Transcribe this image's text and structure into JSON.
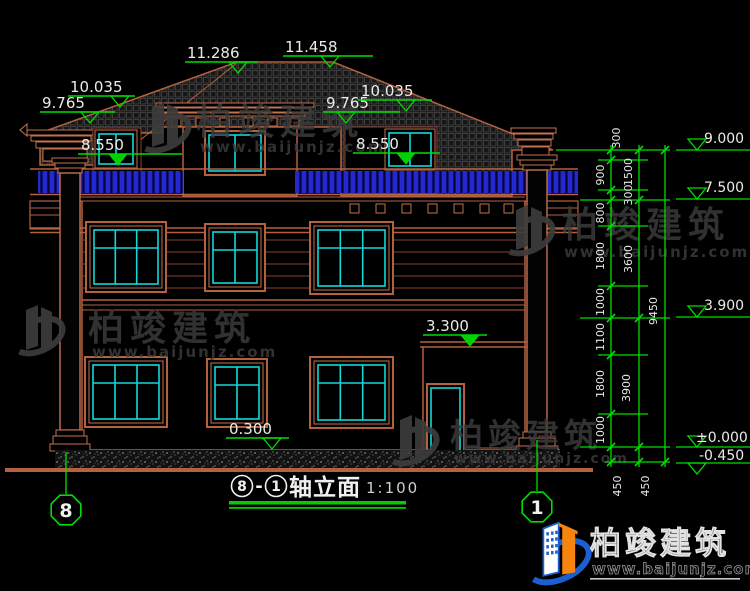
{
  "title": {
    "axis_start": "8",
    "separator": "-",
    "axis_end": "1",
    "name": "轴立面",
    "scale": "1:100"
  },
  "marks": {
    "peak_left": "11.286",
    "peak_right": "11.458",
    "upper_left": "10.035",
    "mid_left": "9.765",
    "rail_left": "8.550",
    "mid_right": "9.765",
    "upper_right": "10.035",
    "rail_right": "8.550",
    "porch_roof": "3.300",
    "plinth": "0.300"
  },
  "levels": {
    "eave": "9.000",
    "attic": "7.500",
    "second": "3.900",
    "first": "±0.000",
    "site": "-0.450"
  },
  "dims": {
    "chain_inner": [
      "300",
      "900",
      "300",
      "800",
      "1800",
      "1000",
      "1100",
      "1800",
      "1000"
    ],
    "chain_mid": [
      "1500",
      "3600",
      "3900"
    ],
    "chain_total": "9450",
    "foundation": [
      "450",
      "450"
    ]
  },
  "axes": {
    "left": "8",
    "right": "1"
  },
  "watermark": {
    "name": "柏竣建筑",
    "url": "www.baijunjz.com"
  },
  "brand": {
    "name": "柏竣建筑",
    "url": "www.baijunjz.com"
  },
  "colors": {
    "dimension_green": "#00dd00",
    "outline_brown": "#b4613f",
    "glazing_cyan": "#12d8d8",
    "railing_blue": "#2428d0",
    "text_white": "#ecebe6",
    "watermark_gray": "#3c3c3c",
    "brand_blue": "#1d5fd0",
    "brand_orange": "#f5850f"
  }
}
